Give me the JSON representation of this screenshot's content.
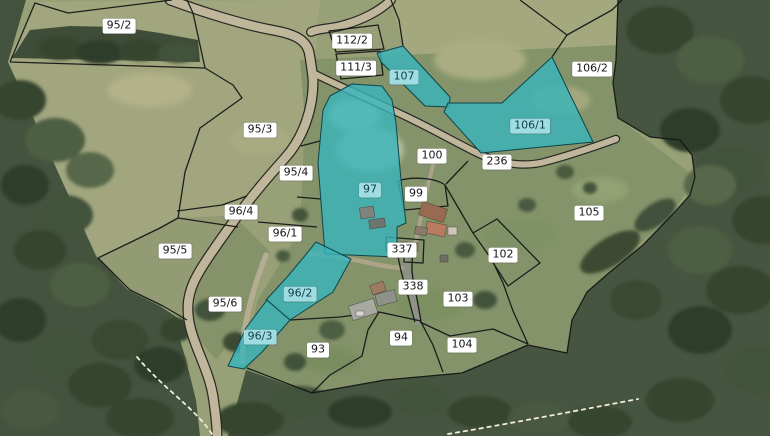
{
  "map": {
    "kind": "cadastral-parcel-map-over-aerial-imagery",
    "colors": {
      "selected_parcel_fill": "#38b5bb",
      "selected_parcel_border": "#0d454b",
      "parcel_line": "#141414",
      "label_bg": "#ffffff",
      "label_text": "#161616",
      "selected_label_bg": "#9fdde2",
      "selected_label_text": "#123d4b",
      "road": "#bfb69c",
      "field_olive": "#a2a67e",
      "field_green": "#87956b",
      "forest": "#44533d",
      "footpath_dash": "#f2ecd9"
    },
    "selected_parcel_ids": [
      "107",
      "106/1",
      "97",
      "96/2",
      "96/3"
    ],
    "parcels": [
      {
        "id": "95/2",
        "x": 119,
        "y": 26,
        "selected": false
      },
      {
        "id": "112/2",
        "x": 352,
        "y": 41,
        "selected": false
      },
      {
        "id": "111/3",
        "x": 356,
        "y": 68,
        "selected": false
      },
      {
        "id": "107",
        "x": 404,
        "y": 77,
        "selected": true
      },
      {
        "id": "106/2",
        "x": 592,
        "y": 69,
        "selected": false
      },
      {
        "id": "106/1",
        "x": 530,
        "y": 126,
        "selected": true
      },
      {
        "id": "95/3",
        "x": 260,
        "y": 130,
        "selected": false
      },
      {
        "id": "100",
        "x": 432,
        "y": 156,
        "selected": false
      },
      {
        "id": "236",
        "x": 497,
        "y": 162,
        "selected": false
      },
      {
        "id": "95/4",
        "x": 296,
        "y": 173,
        "selected": false
      },
      {
        "id": "97",
        "x": 370,
        "y": 190,
        "selected": true
      },
      {
        "id": "99",
        "x": 416,
        "y": 194,
        "selected": false
      },
      {
        "id": "96/4",
        "x": 241,
        "y": 212,
        "selected": false
      },
      {
        "id": "105",
        "x": 589,
        "y": 213,
        "selected": false
      },
      {
        "id": "96/1",
        "x": 285,
        "y": 234,
        "selected": false
      },
      {
        "id": "95/5",
        "x": 175,
        "y": 251,
        "selected": false
      },
      {
        "id": "337",
        "x": 402,
        "y": 250,
        "selected": false
      },
      {
        "id": "102",
        "x": 503,
        "y": 255,
        "selected": false
      },
      {
        "id": "338",
        "x": 413,
        "y": 287,
        "selected": false
      },
      {
        "id": "96/2",
        "x": 300,
        "y": 294,
        "selected": true
      },
      {
        "id": "103",
        "x": 458,
        "y": 299,
        "selected": false
      },
      {
        "id": "95/6",
        "x": 225,
        "y": 304,
        "selected": false
      },
      {
        "id": "96/3",
        "x": 260,
        "y": 337,
        "selected": true
      },
      {
        "id": "94",
        "x": 401,
        "y": 338,
        "selected": false
      },
      {
        "id": "104",
        "x": 462,
        "y": 345,
        "selected": false
      },
      {
        "id": "93",
        "x": 318,
        "y": 350,
        "selected": false
      }
    ]
  }
}
